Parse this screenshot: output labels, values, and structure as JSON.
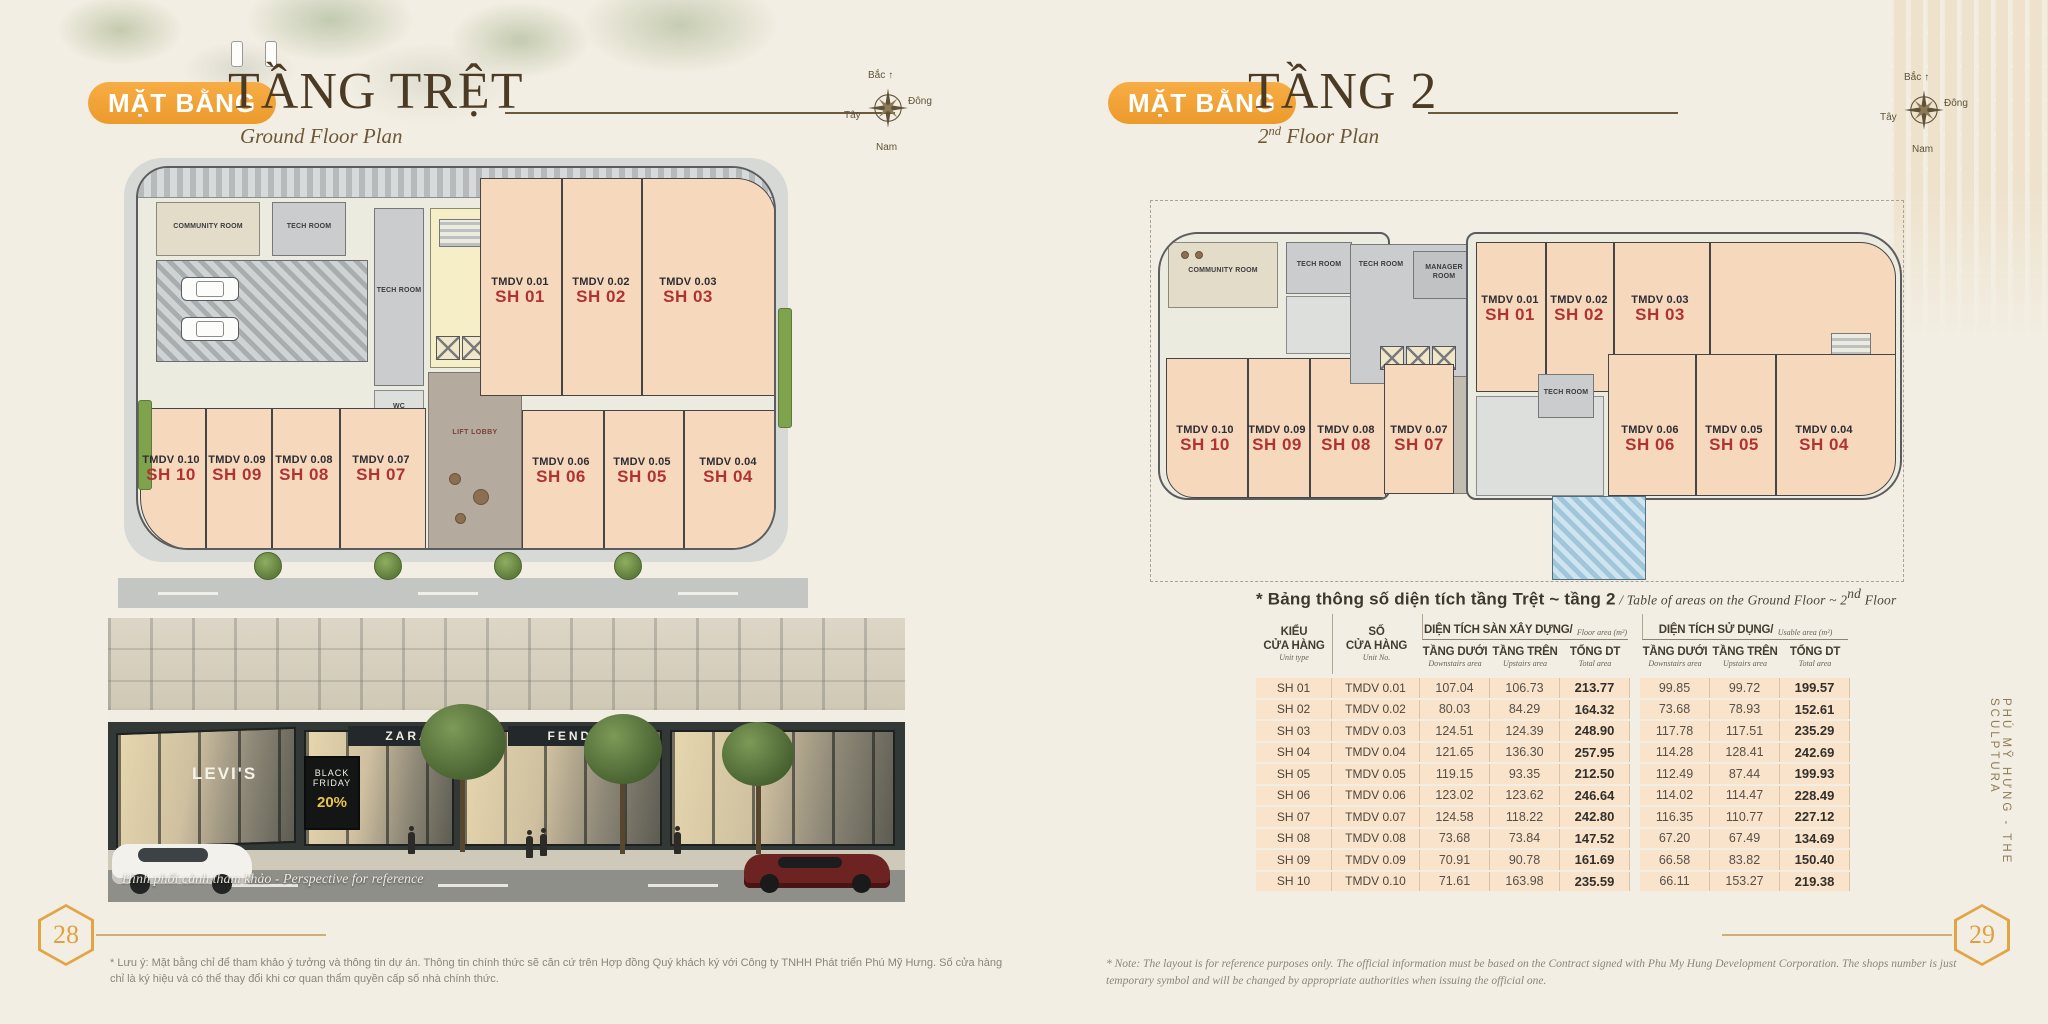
{
  "left_page": {
    "badge": "MẶT BẰNG",
    "title": "TẦNG TRỆT",
    "subtitle": "Ground Floor Plan",
    "page_number": "28",
    "footnote": "* Lưu ý: Mặt bằng chỉ để tham khảo ý tưởng và thông tin dự án. Thông tin chính thức sẽ căn cứ trên Hợp đồng Quý khách ký với Công ty TNHH Phát triển Phú Mỹ Hưng. Số cửa hàng chỉ là ký hiệu và có thể thay đổi khi cơ quan thẩm quyền cấp số nhà chính thức."
  },
  "right_page": {
    "badge": "MẶT BẰNG",
    "title": "TẦNG 2",
    "subtitle_num": "2",
    "subtitle_sup": "nd",
    "subtitle_rest": " Floor Plan",
    "page_number": "29",
    "footnote": "* Note: The layout is for reference purposes only. The official information must be based on the Contract signed with Phu My Hung Development Corporation. The shops number is just temporary symbol and will be changed by appropriate authorities when issuing the official one."
  },
  "compass": {
    "north": "Bắc",
    "east": "Đông",
    "west": "Tây",
    "south": "Nam"
  },
  "side_label": "PHÚ MỸ HƯNG  -  THE SCULPTURA",
  "photo": {
    "caption": "Hình phối cảnh tham khảo - Perspective for reference",
    "signs": {
      "levis": "LEVI'S",
      "board_line1": "BLACK",
      "board_line2": "FRIDAY",
      "board_discount": "20%",
      "sign_left": "ZARA",
      "sign_right": "FENDI"
    }
  },
  "plans": {
    "ground": {
      "rooms": {
        "community": "COMMUNITY ROOM",
        "tech": "TECH ROOM",
        "wc": "WC",
        "lift": "LIFT LOBBY"
      },
      "units": [
        {
          "no": "TMDV 0.01",
          "sh": "SH 01"
        },
        {
          "no": "TMDV 0.02",
          "sh": "SH 02"
        },
        {
          "no": "TMDV 0.03",
          "sh": "SH 03"
        },
        {
          "no": "TMDV 0.04",
          "sh": "SH 04"
        },
        {
          "no": "TMDV 0.05",
          "sh": "SH 05"
        },
        {
          "no": "TMDV 0.06",
          "sh": "SH 06"
        },
        {
          "no": "TMDV 0.07",
          "sh": "SH 07"
        },
        {
          "no": "TMDV 0.08",
          "sh": "SH 08"
        },
        {
          "no": "TMDV 0.09",
          "sh": "SH 09"
        },
        {
          "no": "TMDV 0.10",
          "sh": "SH 10"
        }
      ]
    },
    "floor2": {
      "rooms": {
        "community": "COMMUNITY ROOM",
        "tech": "TECH ROOM",
        "manager": "MANAGER ROOM",
        "lift": "LIFT LOBBY"
      },
      "units": [
        {
          "no": "TMDV 0.01",
          "sh": "SH 01"
        },
        {
          "no": "TMDV 0.02",
          "sh": "SH 02"
        },
        {
          "no": "TMDV 0.03",
          "sh": "SH 03"
        },
        {
          "no": "TMDV 0.04",
          "sh": "SH 04"
        },
        {
          "no": "TMDV 0.05",
          "sh": "SH 05"
        },
        {
          "no": "TMDV 0.06",
          "sh": "SH 06"
        },
        {
          "no": "TMDV 0.07",
          "sh": "SH 07"
        },
        {
          "no": "TMDV 0.08",
          "sh": "SH 08"
        },
        {
          "no": "TMDV 0.09",
          "sh": "SH 09"
        },
        {
          "no": "TMDV 0.10",
          "sh": "SH 10"
        }
      ]
    }
  },
  "table": {
    "title_vi": "* Bảng thông số diện tích tầng Trệt ~ tầng 2",
    "title_divider": " / ",
    "title_en_prefix": "Table of areas on the Ground Floor ~ 2",
    "title_en_sup": "nd",
    "title_en_suffix": " Floor",
    "headers": {
      "unit_type": {
        "vi1": "KIỂU",
        "vi2": "CỬA HÀNG",
        "en": "Unit type"
      },
      "unit_no": {
        "vi1": "SỐ",
        "vi2": "CỬA HÀNG",
        "en": "Unit No."
      },
      "group1": {
        "vi": "DIỆN TÍCH SÀN XÂY DỰNG/",
        "en": "Floor area (m²)"
      },
      "group2": {
        "vi": "DIỆN TÍCH SỬ DỤNG/",
        "en": "Usable area (m²)"
      },
      "sub": [
        {
          "vi": "TẦNG DƯỚI",
          "en": "Downstairs area"
        },
        {
          "vi": "TẦNG TRÊN",
          "en": "Upstairs area"
        },
        {
          "vi": "TỔNG DT",
          "en": "Total area"
        }
      ]
    },
    "rows": [
      [
        "SH 01",
        "TMDV 0.01",
        "107.04",
        "106.73",
        "213.77",
        "99.85",
        "99.72",
        "199.57"
      ],
      [
        "SH 02",
        "TMDV 0.02",
        "80.03",
        "84.29",
        "164.32",
        "73.68",
        "78.93",
        "152.61"
      ],
      [
        "SH 03",
        "TMDV 0.03",
        "124.51",
        "124.39",
        "248.90",
        "117.78",
        "117.51",
        "235.29"
      ],
      [
        "SH 04",
        "TMDV 0.04",
        "121.65",
        "136.30",
        "257.95",
        "114.28",
        "128.41",
        "242.69"
      ],
      [
        "SH 05",
        "TMDV 0.05",
        "119.15",
        "93.35",
        "212.50",
        "112.49",
        "87.44",
        "199.93"
      ],
      [
        "SH 06",
        "TMDV 0.06",
        "123.02",
        "123.62",
        "246.64",
        "114.02",
        "114.47",
        "228.49"
      ],
      [
        "SH 07",
        "TMDV 0.07",
        "124.58",
        "118.22",
        "242.80",
        "116.35",
        "110.77",
        "227.12"
      ],
      [
        "SH 08",
        "TMDV 0.08",
        "73.68",
        "73.84",
        "147.52",
        "67.20",
        "67.49",
        "134.69"
      ],
      [
        "SH 09",
        "TMDV 0.09",
        "70.91",
        "90.78",
        "161.69",
        "66.58",
        "83.82",
        "150.40"
      ],
      [
        "SH 10",
        "TMDV 0.10",
        "71.61",
        "163.98",
        "235.59",
        "66.11",
        "153.27",
        "219.38"
      ]
    ]
  }
}
